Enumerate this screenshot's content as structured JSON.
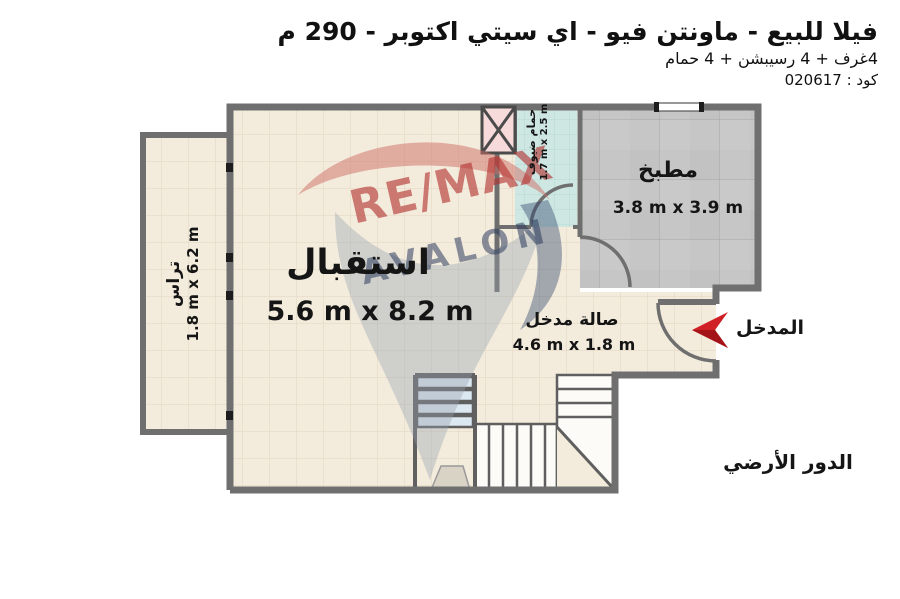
{
  "header": {
    "title": "فيلا للبيع - ماونتن فيو - اي سيتي اكتوبر - 290 م",
    "subtitle": "4غرف + 4 رسيبشن + 4 حمام",
    "code": "كود : 020617"
  },
  "floor_plan": {
    "floor_label": "الدور الأرضي",
    "entrance_label": "المدخل",
    "rooms": [
      {
        "name": "استقبال",
        "dimensions": "5.6 m x 8.2 m"
      },
      {
        "name": "مطبخ",
        "dimensions": "3.8 m x 3.9 m"
      },
      {
        "name": "صالة مدخل",
        "dimensions": "4.6 m x 1.8 m"
      },
      {
        "name": "تراس",
        "dimensions": "1.8 m x 6.2 m"
      },
      {
        "name": "حمام ضيوف",
        "dimensions": "1.7 m x 2.5 m"
      }
    ]
  },
  "watermark": {
    "brand": "RE/MAX",
    "sub": "AVALON"
  },
  "colors": {
    "accent_red": "#d02025",
    "wall_gray": "#6f6f6f",
    "floor_cream": "#f3ecdd",
    "floor_kitchen": "#c6c6c6",
    "floor_bath_teal": "#cee7e2",
    "shaft_pink": "#f7dada",
    "stair_blue": "#dbe7f1"
  }
}
